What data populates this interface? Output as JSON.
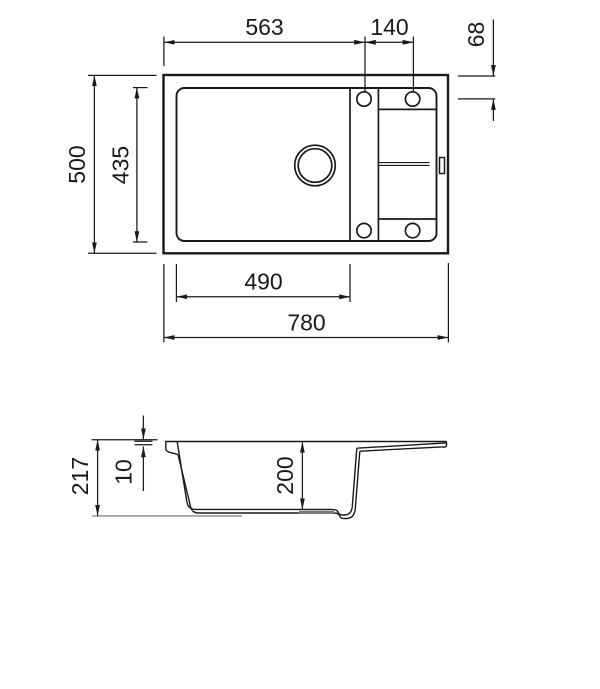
{
  "colors": {
    "line": "#1a1a1a",
    "background": "#ffffff",
    "baseline_gray": "#8c8c8c",
    "drain_recess_gray": "#777777"
  },
  "top_view": {
    "dims": {
      "tap_offset_from_left": "563",
      "tap_hole_spacing": "140",
      "tap_inset_from_top": "68",
      "overall_depth": "500",
      "inner_depth": "435",
      "bowl_length": "490",
      "overall_length": "780"
    }
  },
  "side_view": {
    "dims": {
      "overall_height": "217",
      "rim_thickness": "10",
      "bowl_depth": "200"
    }
  }
}
